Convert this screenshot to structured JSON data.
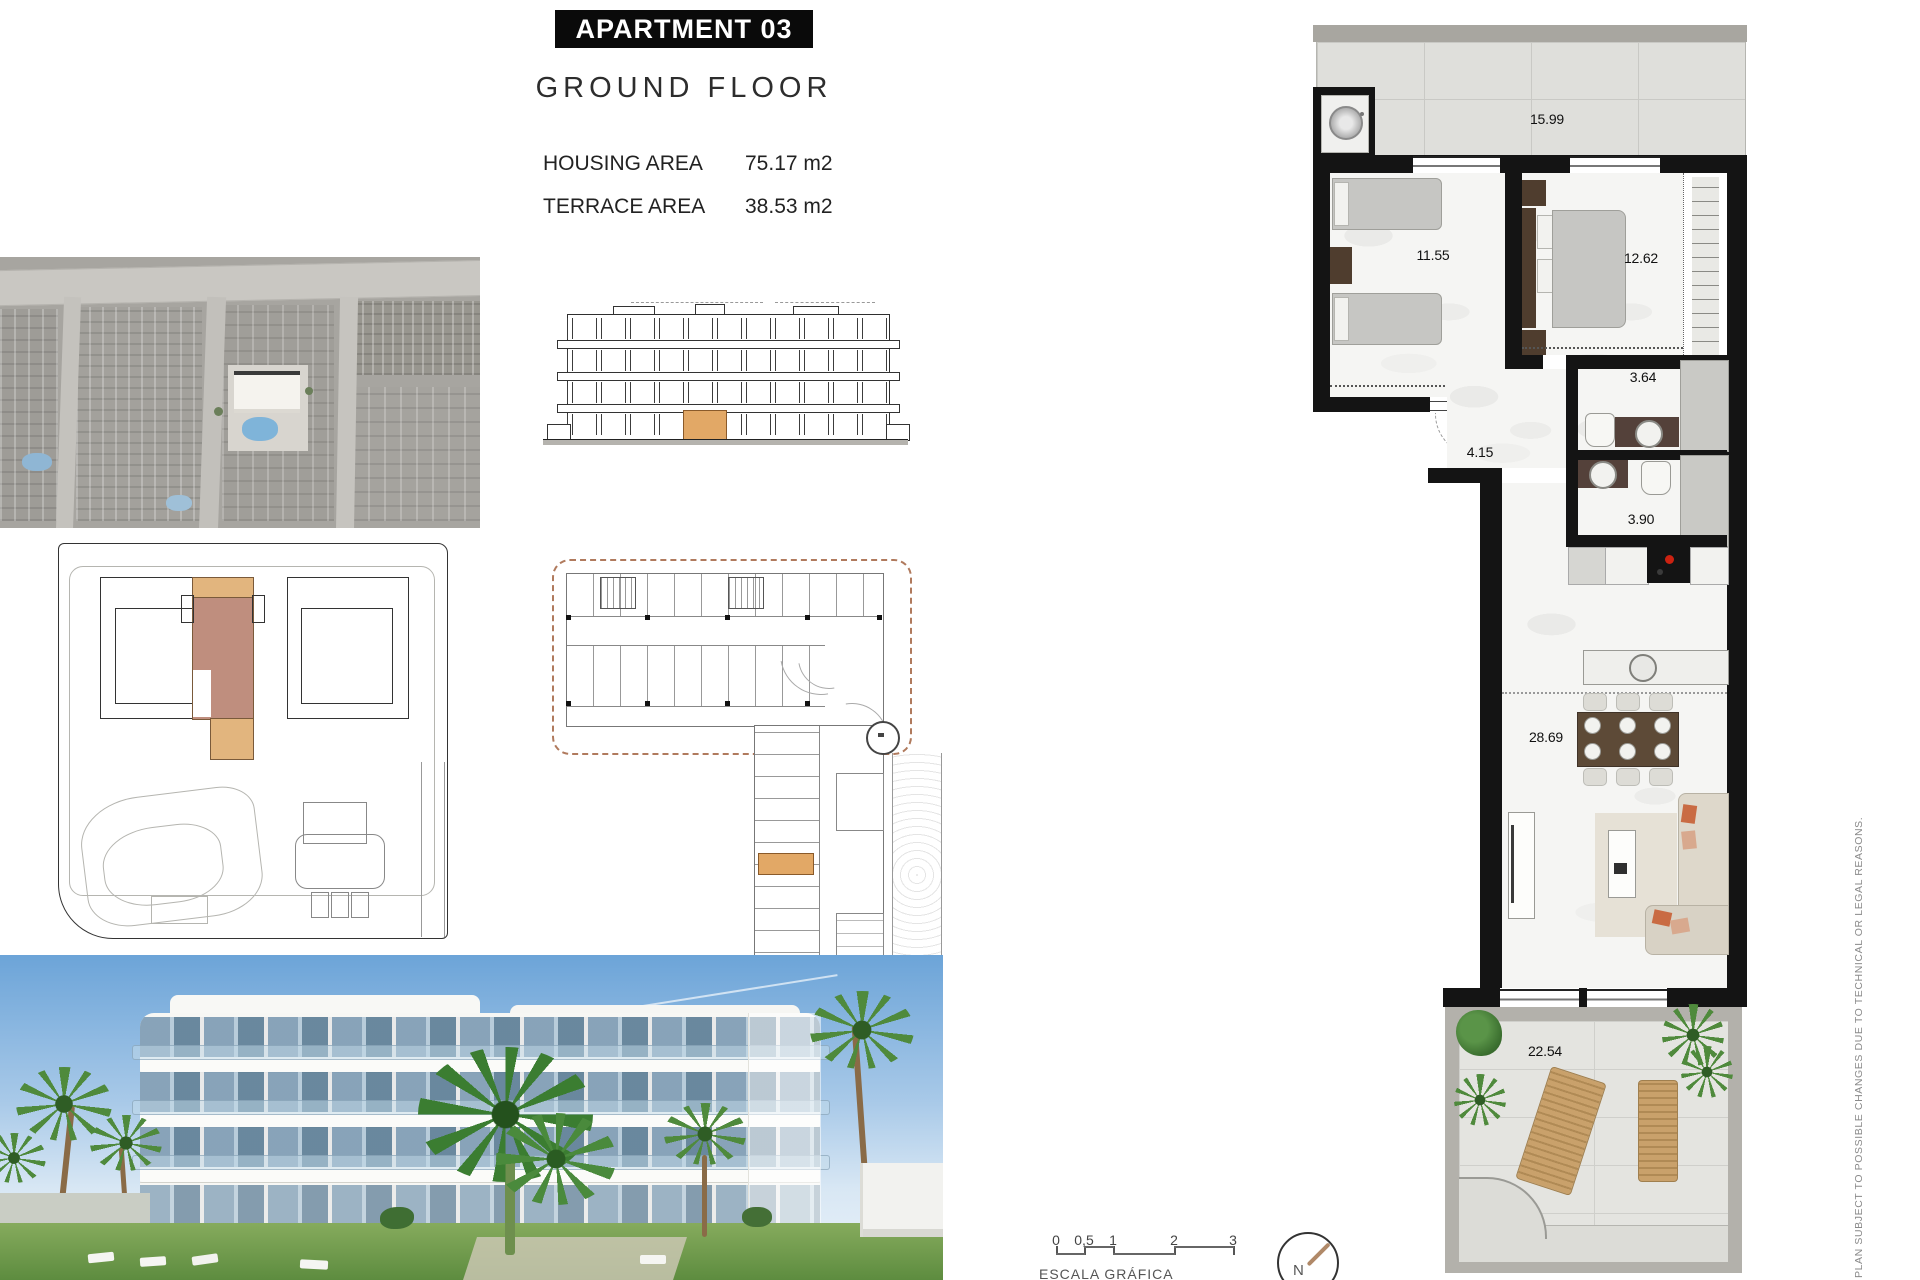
{
  "header": {
    "title": "APARTMENT 03",
    "subtitle": "GROUND FLOOR",
    "housing_label": "HOUSING AREA",
    "housing_value": "75.17 m2",
    "terrace_label": "TERRACE AREA",
    "terrace_value": "38.53 m2"
  },
  "floor_plan": {
    "rooms": [
      {
        "name": "laundry terrace",
        "area": "15.99"
      },
      {
        "name": "bedroom 2",
        "area": "11.55"
      },
      {
        "name": "master bedroom",
        "area": "12.62"
      },
      {
        "name": "bathroom 1",
        "area": "3.64"
      },
      {
        "name": "hallway",
        "area": "4.15"
      },
      {
        "name": "bathroom 2",
        "area": "3.90"
      },
      {
        "name": "living dining kitchen",
        "area": "28.69"
      },
      {
        "name": "terrace",
        "area": "22.54"
      }
    ]
  },
  "scale_bar": {
    "ticks": [
      "0",
      "0,5",
      "1",
      "2",
      "3"
    ],
    "label": "ESCALA GRÁFICA"
  },
  "compass": {
    "label": "N"
  },
  "disclaimer": {
    "text": "PLAN SUBJECT TO POSSIBLE CHANGES DUE TO TECHNICAL OR LEGAL REASONS."
  },
  "colors": {
    "highlight_orange": "#e2b57e",
    "highlight_mauve": "#bf8e7e",
    "elevation_unit": "#e2a866",
    "wall": "#141414",
    "dash_boundary": "#b07a5d",
    "wood": "#5d4a37",
    "cooktop_red": "#cc2211",
    "pool_blue": "#7fb4d9",
    "palm_green": "#4a7f35"
  }
}
